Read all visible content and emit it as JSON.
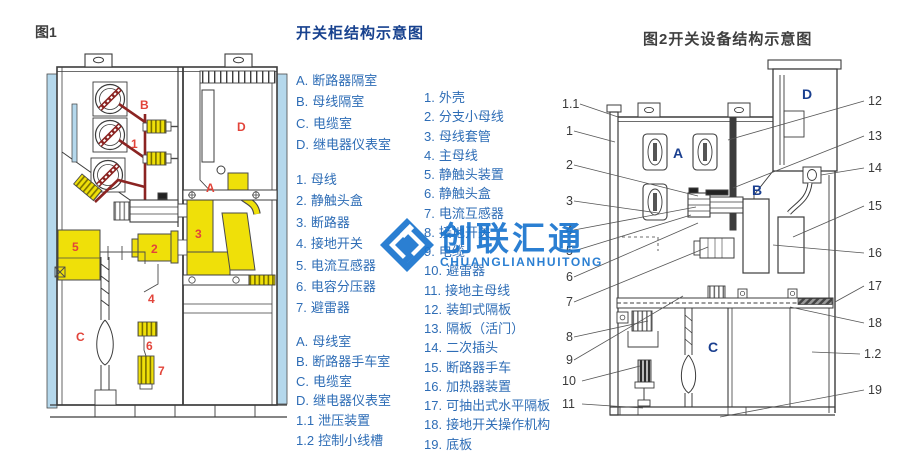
{
  "figure1": {
    "caption": "图1",
    "part_labels": [
      "B",
      "1",
      "D",
      "A",
      "5",
      "2",
      "3",
      "4",
      "6",
      "7",
      "C"
    ]
  },
  "legend_main": {
    "title": "开关柜结构示意图",
    "compartments": [
      {
        "num": "A.",
        "text": "断路器隔室"
      },
      {
        "num": "B.",
        "text": "母线隔室"
      },
      {
        "num": "C.",
        "text": "电缆室"
      },
      {
        "num": "D.",
        "text": "继电器仪表室"
      }
    ],
    "parts": [
      {
        "num": "1.",
        "text": "母线"
      },
      {
        "num": "2.",
        "text": "静触头盒"
      },
      {
        "num": "3.",
        "text": "断路器"
      },
      {
        "num": "4.",
        "text": "接地开关"
      },
      {
        "num": "5.",
        "text": "电流互感器"
      },
      {
        "num": "6.",
        "text": "电容分压器"
      },
      {
        "num": "7.",
        "text": "避雷器"
      }
    ],
    "rooms": [
      {
        "num": "A.",
        "text": "母线室"
      },
      {
        "num": "B.",
        "text": "断路器手车室"
      },
      {
        "num": "C.",
        "text": "电缆室"
      },
      {
        "num": "D.",
        "text": "继电器仪表室"
      },
      {
        "num": "1.1",
        "text": "泄压装置"
      },
      {
        "num": "1.2",
        "text": "控制小线槽"
      }
    ]
  },
  "legend_fig2": {
    "parts": [
      {
        "num": "1.",
        "text": "外壳"
      },
      {
        "num": "2.",
        "text": "分支小母线"
      },
      {
        "num": "3.",
        "text": "母线套管"
      },
      {
        "num": "4.",
        "text": "主母线"
      },
      {
        "num": "5.",
        "text": "静触头装置"
      },
      {
        "num": "6.",
        "text": "静触头盒"
      },
      {
        "num": "7.",
        "text": "电流互感器"
      },
      {
        "num": "8.",
        "text": "接地开关"
      },
      {
        "num": "9.",
        "text": "电缆"
      },
      {
        "num": "10.",
        "text": "避雷器"
      },
      {
        "num": "11.",
        "text": "接地主母线"
      },
      {
        "num": "12.",
        "text": "装卸式隔板"
      },
      {
        "num": "13.",
        "text": "隔板（活门）"
      },
      {
        "num": "14.",
        "text": "二次插头"
      },
      {
        "num": "15.",
        "text": "断路器手车"
      },
      {
        "num": "16.",
        "text": "加热器装置"
      },
      {
        "num": "17.",
        "text": "可抽出式水平隔板"
      },
      {
        "num": "18.",
        "text": "接地开关操作机构"
      },
      {
        "num": "19.",
        "text": "底板"
      }
    ]
  },
  "figure2": {
    "title": "图2开关设备结构示意图",
    "left_callouts": [
      "1.1",
      "1",
      "2",
      "3",
      "4",
      "5",
      "6",
      "7",
      "8",
      "9",
      "10",
      "11"
    ],
    "right_callouts": [
      "12",
      "13",
      "14",
      "15",
      "16",
      "17",
      "18",
      "1.2",
      "19"
    ],
    "compartment_letters": [
      "A",
      "B",
      "C",
      "D"
    ]
  },
  "watermark": {
    "logo": "diamond-logo",
    "text": "创联汇通",
    "subtext": "CHUANGLIANHUITONG",
    "color": "#1b76cf"
  },
  "colors": {
    "legend_blue": "#2e6db6",
    "title_navy": "#17418e",
    "label_red": "#e2443a",
    "busbar_dark_red": "#8b2422",
    "component_yellow": "#efe009",
    "panel_light_blue": "#b5d8ec"
  }
}
